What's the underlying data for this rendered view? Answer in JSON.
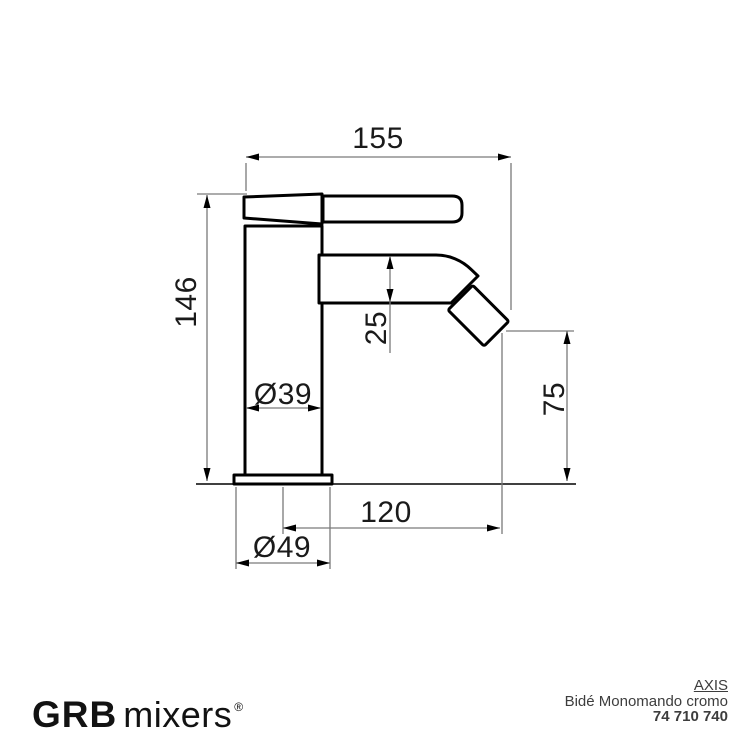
{
  "drawing_title": "Bidet mixer technical dimension drawing",
  "dims": {
    "top_width": "155",
    "height": "146",
    "spout_height": "25",
    "body_diameter": "Ø39",
    "outlet_height": "75",
    "reach": "120",
    "base_diameter": "Ø49"
  },
  "footer": {
    "brand": "GRB",
    "brand_suffix": "mixers",
    "registered_mark": "®",
    "series": "AXIS",
    "product_name": "Bidé Monomando cromo",
    "product_code": "74 710 740"
  },
  "colors": {
    "background": "#ffffff",
    "outline": "#000000",
    "dimension_line": "#7a7a7a",
    "text": "#1a1a1a"
  }
}
